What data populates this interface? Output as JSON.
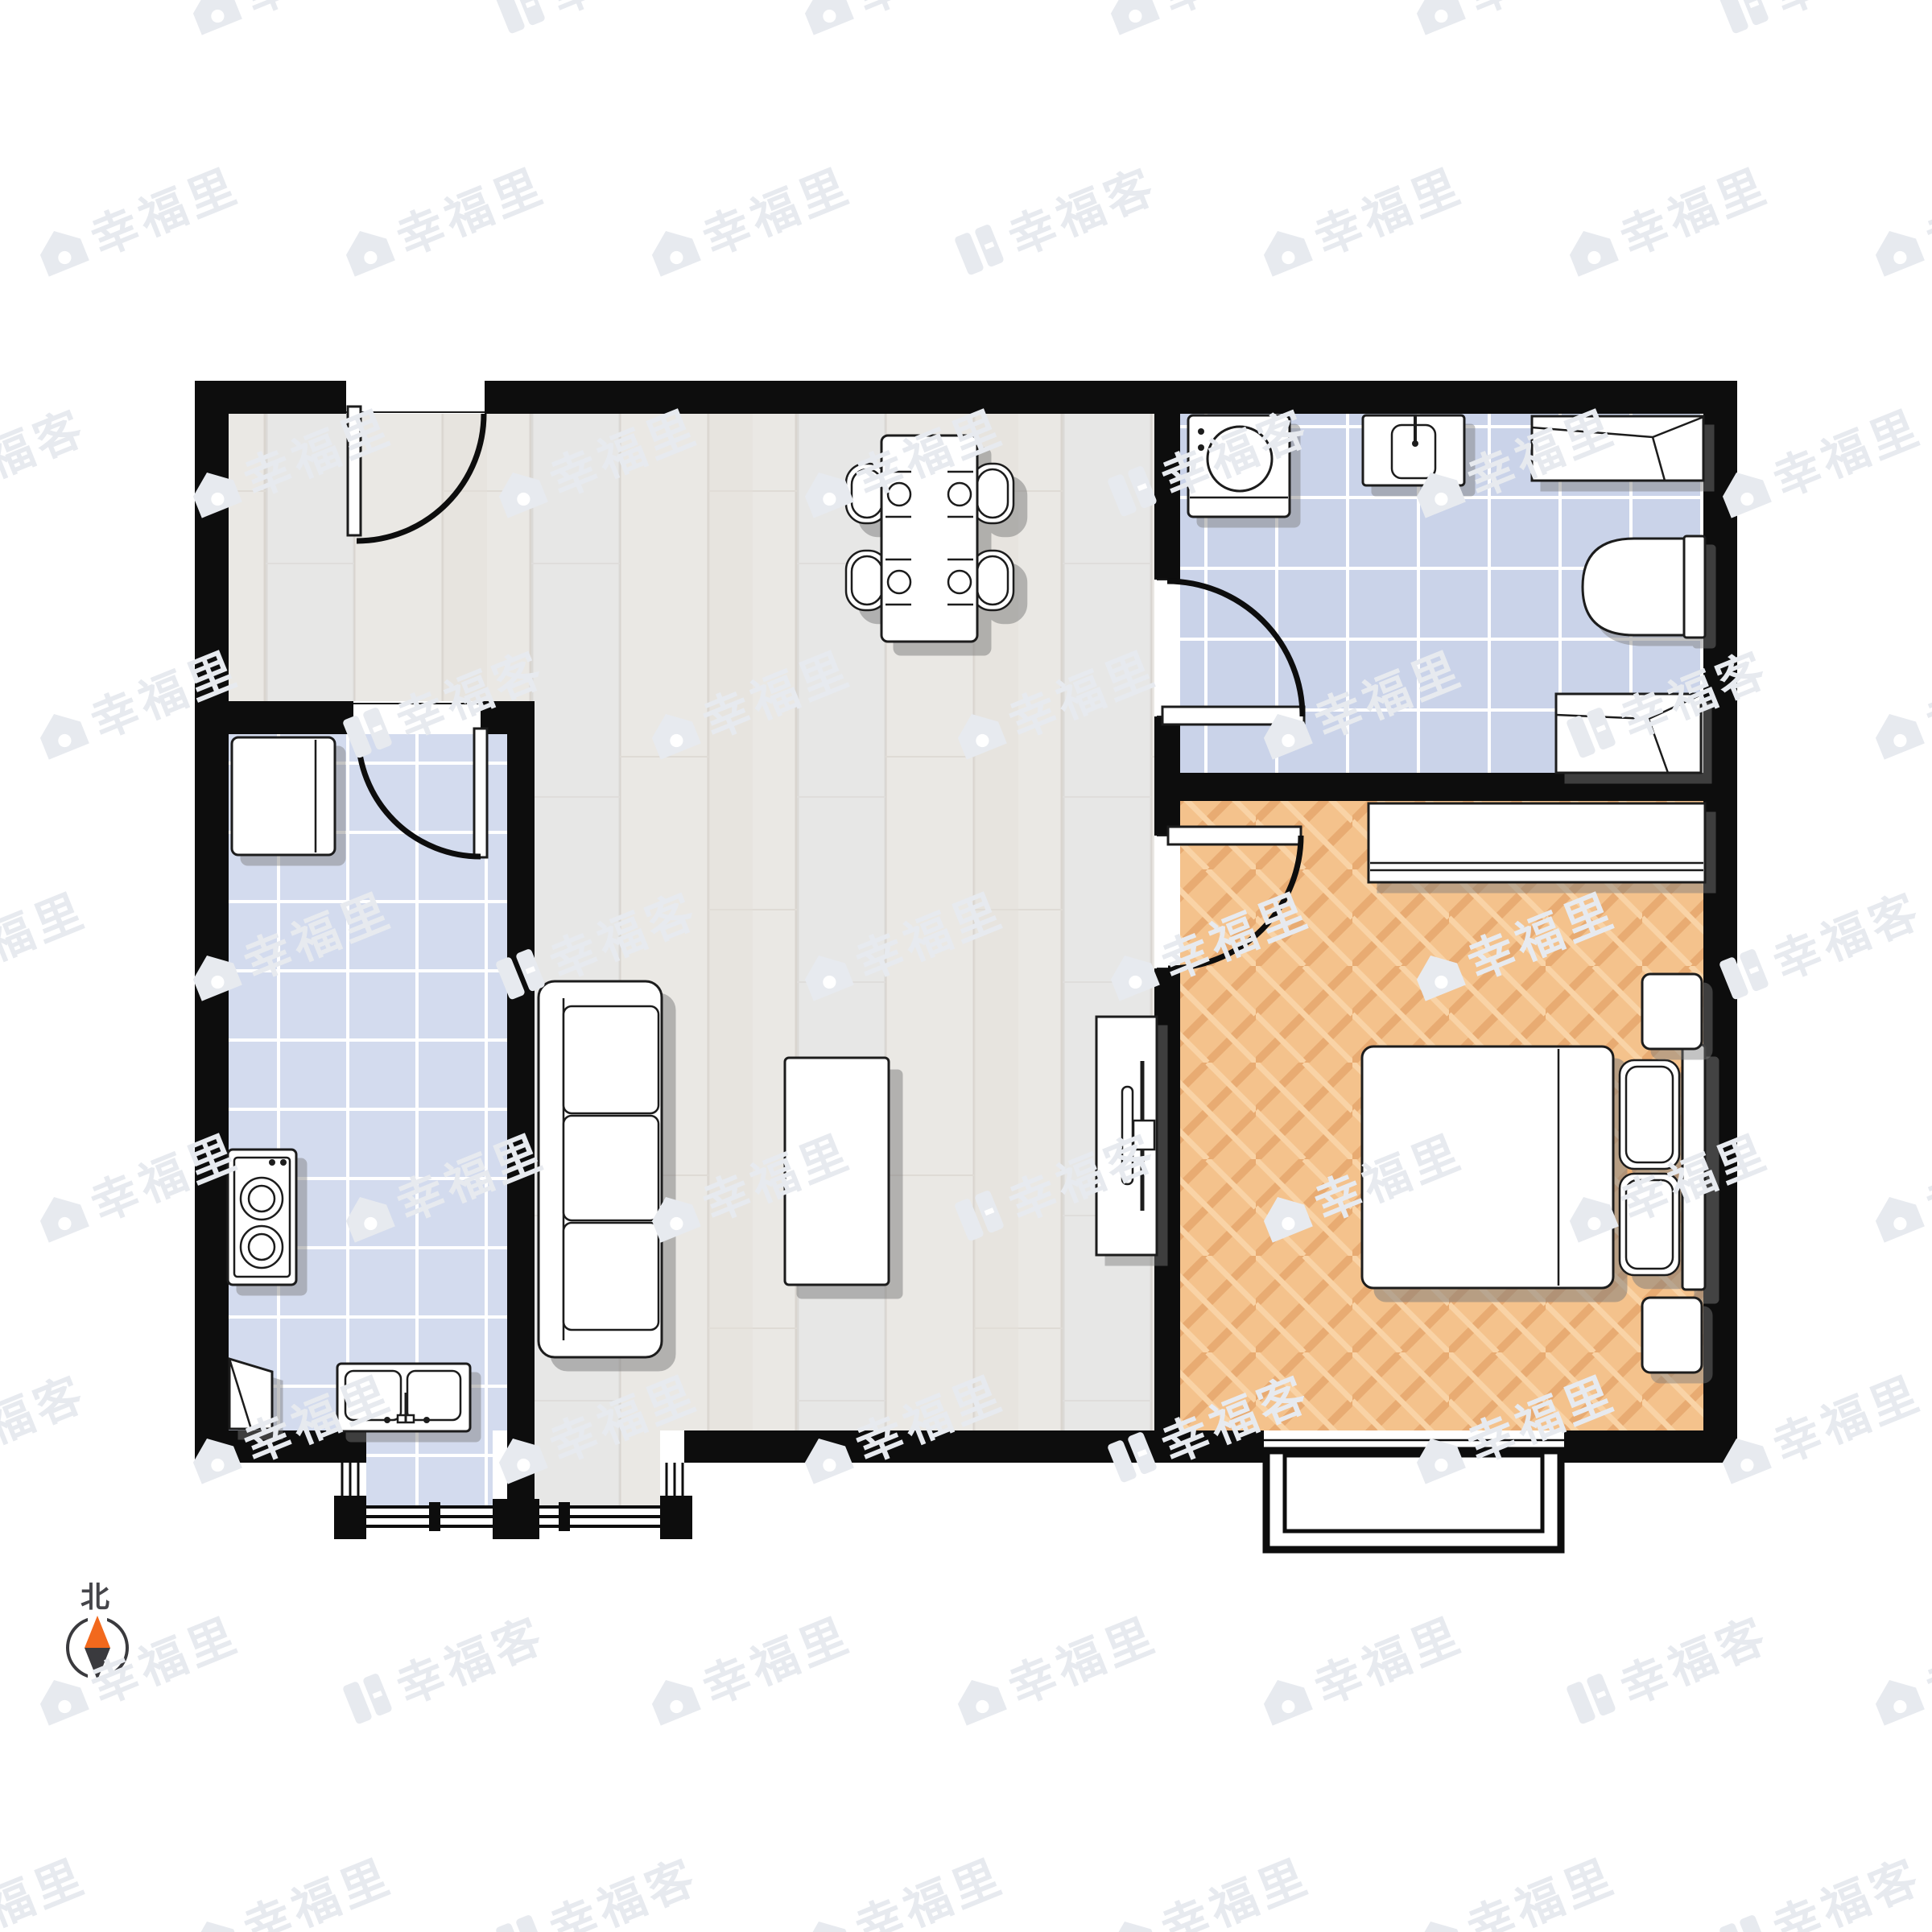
{
  "compass": {
    "north_label": "北"
  },
  "watermark": {
    "brand_primary": "幸福里",
    "brand_secondary": "幸福客",
    "color": "#e7eaef"
  },
  "colors": {
    "wall": "#0d0d0d",
    "floor_wood": "#eae8e4",
    "floor_tile_bathroom": "#ccd5e9",
    "floor_tile_kitchen": "#d3dbee",
    "floor_parquet": "#f4c28c",
    "furniture_fill": "#ffffff",
    "furniture_stroke": "#1c1c1c",
    "shadow": "#7a7a7a",
    "compass_north": "#f2691d",
    "compass_south": "#3a3a3e"
  },
  "rooms": [
    {
      "name": "living-dining",
      "floor": "light-wood-plank"
    },
    {
      "name": "kitchen",
      "floor": "blue-tile"
    },
    {
      "name": "bathroom",
      "floor": "blue-tile"
    },
    {
      "name": "bedroom",
      "floor": "orange-parquet"
    }
  ],
  "fixtures": [
    "entry-door",
    "kitchen-door",
    "bathroom-door",
    "bedroom-door",
    "dining-table-with-4-chairs",
    "sofa-3-seat",
    "coffee-table",
    "tv-cabinet",
    "tv",
    "refrigerator",
    "cooktop-2-burner",
    "double-kitchen-sink",
    "corner-shelf",
    "washing-machine",
    "wash-basin",
    "shower-cabinet",
    "toilet",
    "bath-cabinet",
    "wardrobe",
    "double-bed",
    "pillows",
    "nightstand-upper",
    "nightstand-lower",
    "bay-window-bedroom",
    "window-bay-kitchen-living",
    "compass-north-arrow"
  ]
}
